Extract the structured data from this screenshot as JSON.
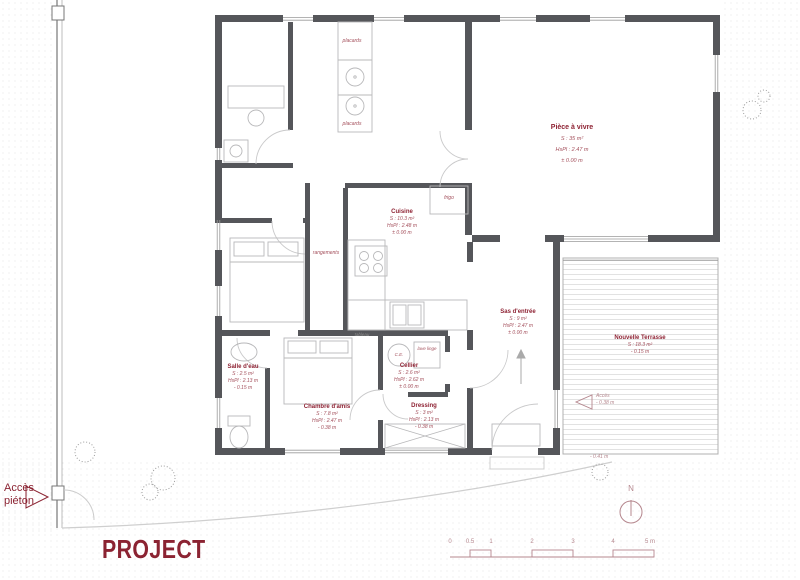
{
  "title": "PROJECT",
  "colors": {
    "accent_red": "#8b2332",
    "label_red": "#a4505c",
    "wall_gray": "#55565a",
    "scale_red": "#b5878e"
  },
  "site": {
    "acces_pieton_line1": "Accès",
    "acces_pieton_line2": "piéton",
    "north_label": "N"
  },
  "rooms": {
    "piece_a_vivre": {
      "title": "Pièce à vivre",
      "lines": [
        "S : 35 m²",
        "HsPl : 2.47 m",
        "± 0.00 m"
      ]
    },
    "cuisine": {
      "title": "Cuisine",
      "lines": [
        "S : 10.3 m²",
        "HsPl : 2.48 m",
        "± 0.00 m"
      ]
    },
    "sas": {
      "title": "Sas d'entrée",
      "lines": [
        "S : 9 m²",
        "HsPl : 2.47 m",
        "± 0.00 m"
      ]
    },
    "terrasse": {
      "title": "Nouvelle Terrasse",
      "lines": [
        "S : 18.3 m²",
        "- 0.15 m"
      ]
    },
    "salle_eau": {
      "title": "Salle d'eau",
      "lines": [
        "S : 2.5 m²",
        "HsPl : 2.13 m",
        "- 0.15 m"
      ]
    },
    "chambre_amis": {
      "title": "Chambre d'amis",
      "lines": [
        "S : 7.8 m²",
        "HsPl : 2.47 m",
        "- 0.38 m"
      ]
    },
    "cellier": {
      "title": "Cellier",
      "lines": [
        "S : 2.6 m²",
        "HsPl : 2.62 m",
        "± 0.00 m"
      ]
    },
    "dressing": {
      "title": "Dressing",
      "lines": [
        "S : 3 m²",
        "HsPl : 2.13 m",
        "- 0.38 m"
      ]
    }
  },
  "annotations": {
    "placards_top": "placards",
    "placards_bottom": "placards",
    "rangements": "rangements",
    "frigo": "frigo",
    "tableau": "tableau",
    "ce": "C.E.",
    "lave_linge": "lave linge",
    "acces_terrasse": "Accès",
    "acces_terrasse_level": "- 0.38 m",
    "terrasse_edge_level": "- 0.41 m"
  },
  "scale_bar": {
    "labels": [
      "0",
      "0.5",
      "1",
      "2",
      "3",
      "4",
      "5 m"
    ]
  }
}
